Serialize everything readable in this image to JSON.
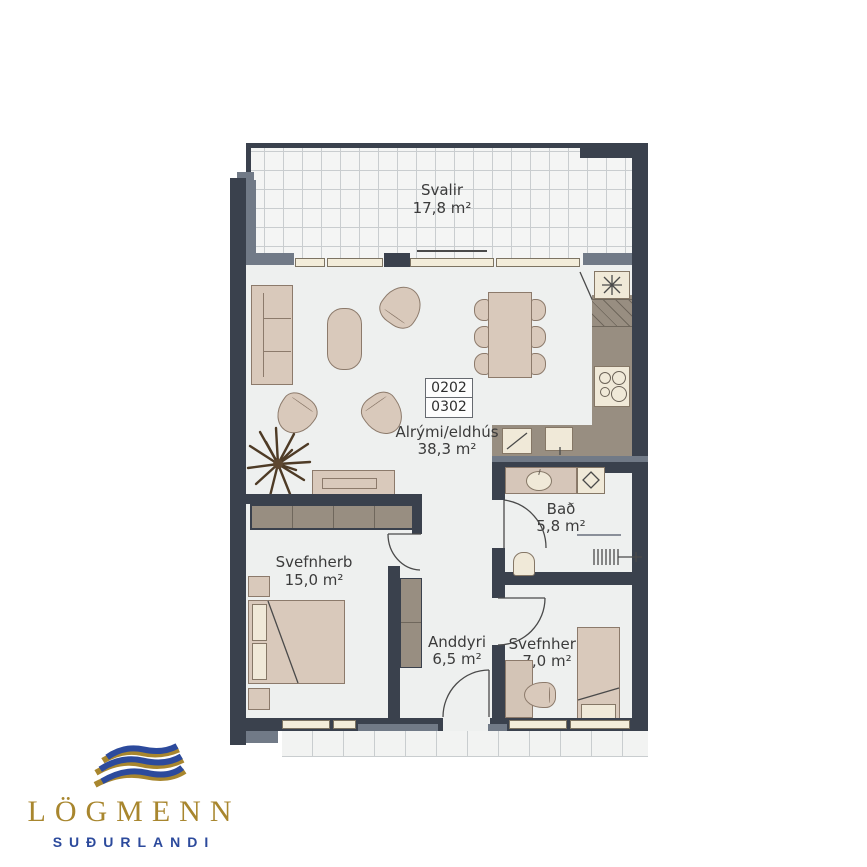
{
  "logo": {
    "brand": "LÖGMENN",
    "subtitle": "SUÐURLANDI",
    "blue": "#2c4a9c",
    "gold": "#a8862e"
  },
  "units": {
    "numbers": [
      "0202",
      "0302"
    ]
  },
  "rooms": {
    "svalir": {
      "name": "Svalir",
      "area": "17,8 m²"
    },
    "alrymi": {
      "name": "Alrými/eldhús",
      "area": "38,3 m²"
    },
    "svefnherb1": {
      "name": "Svefnherb",
      "area": "15,0 m²"
    },
    "bad": {
      "name": "Bað",
      "area": "5,8 m²"
    },
    "anddyri": {
      "name": "Anddyri",
      "area": "6,5 m²"
    },
    "svefnherb2": {
      "name": "Svefnherb",
      "area": "7,0 m²"
    }
  },
  "colors": {
    "wall": "#3a414d",
    "wall_grey": "#717a87",
    "floor": "#eef0ef",
    "furniture_beige": "#d9c9bb",
    "furniture_border": "#8c7a6b",
    "counter_taupe": "#988e81",
    "appliance_cream": "#f0e9d8",
    "label_text": "#3b3b3b"
  }
}
